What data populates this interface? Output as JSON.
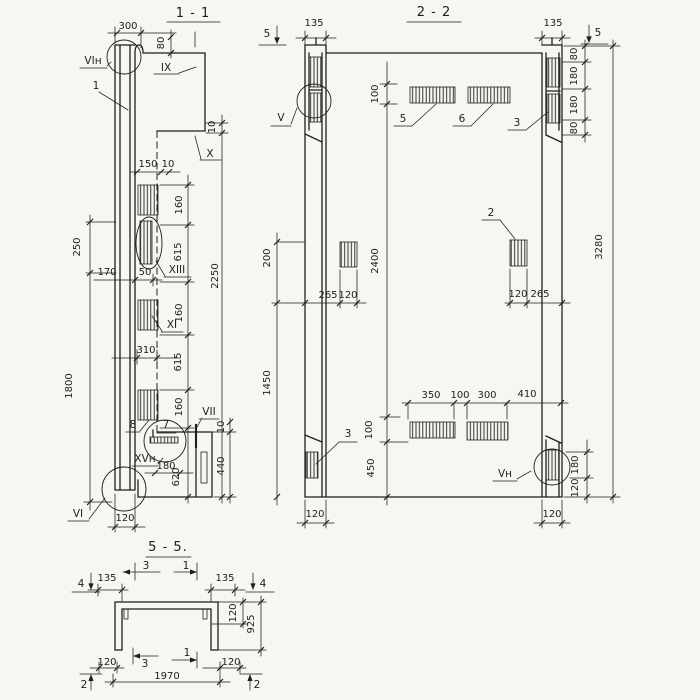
{
  "colors": {
    "paper": "#f7f6f2",
    "ink": "#1e1e1c"
  },
  "s11": {
    "title": "1 - 1",
    "dims": {
      "d300": "300",
      "d80": "80",
      "d150": "150",
      "d10a": "10",
      "d10b": "10",
      "d10c": "10",
      "c160a": "160",
      "c615a": "615",
      "c160b": "160",
      "c615b": "615",
      "c160c": "160",
      "c620": "620",
      "d2250": "2250",
      "d250": "250",
      "d1800": "1800",
      "d170": "170",
      "d50": "50",
      "d310": "310",
      "d180": "180",
      "d440": "440",
      "d120": "120"
    },
    "callouts": {
      "vin": "VIн",
      "n1": "1",
      "ix": "IX",
      "x": "X",
      "xiii": "XIII",
      "xi": "XI",
      "n8": "8",
      "n7": "7",
      "vii": "VII",
      "xvn": "XVн",
      "vi": "VI"
    }
  },
  "s22": {
    "title": "2 - 2",
    "cut_left": "5",
    "cut_right": "5",
    "dims": {
      "d135l": "135",
      "d135r": "135",
      "d80a": "80",
      "d180a": "180",
      "d180b": "180",
      "d80b": "80",
      "d3280": "3280",
      "d100t": "100",
      "d2400": "2400",
      "d200": "200",
      "d1450": "1450",
      "d265l": "265",
      "d120la": "120",
      "d120ra": "120",
      "d265r": "265",
      "d350": "350",
      "d100m": "100",
      "d300": "300",
      "d410": "410",
      "d100b": "100",
      "d450": "450",
      "d180c": "180",
      "d120rb": "120",
      "d120bl": "120",
      "d120br": "120"
    },
    "callouts": {
      "v": "V",
      "n5": "5",
      "n6": "6",
      "n3t": "3",
      "n2": "2",
      "n3b": "3",
      "vn": "Vн"
    }
  },
  "s55": {
    "title": "5 - 5.",
    "dims": {
      "d135l": "135",
      "d135r": "135",
      "d120t": "120",
      "d925": "925",
      "d120bl": "120",
      "d120br": "120",
      "d1970": "1970"
    },
    "cuts": {
      "c4l": "4",
      "c4r": "4",
      "c3t": "3",
      "c1t": "1",
      "c3b": "3",
      "c1b": "1",
      "c2l": "2",
      "c2r": "2"
    }
  }
}
